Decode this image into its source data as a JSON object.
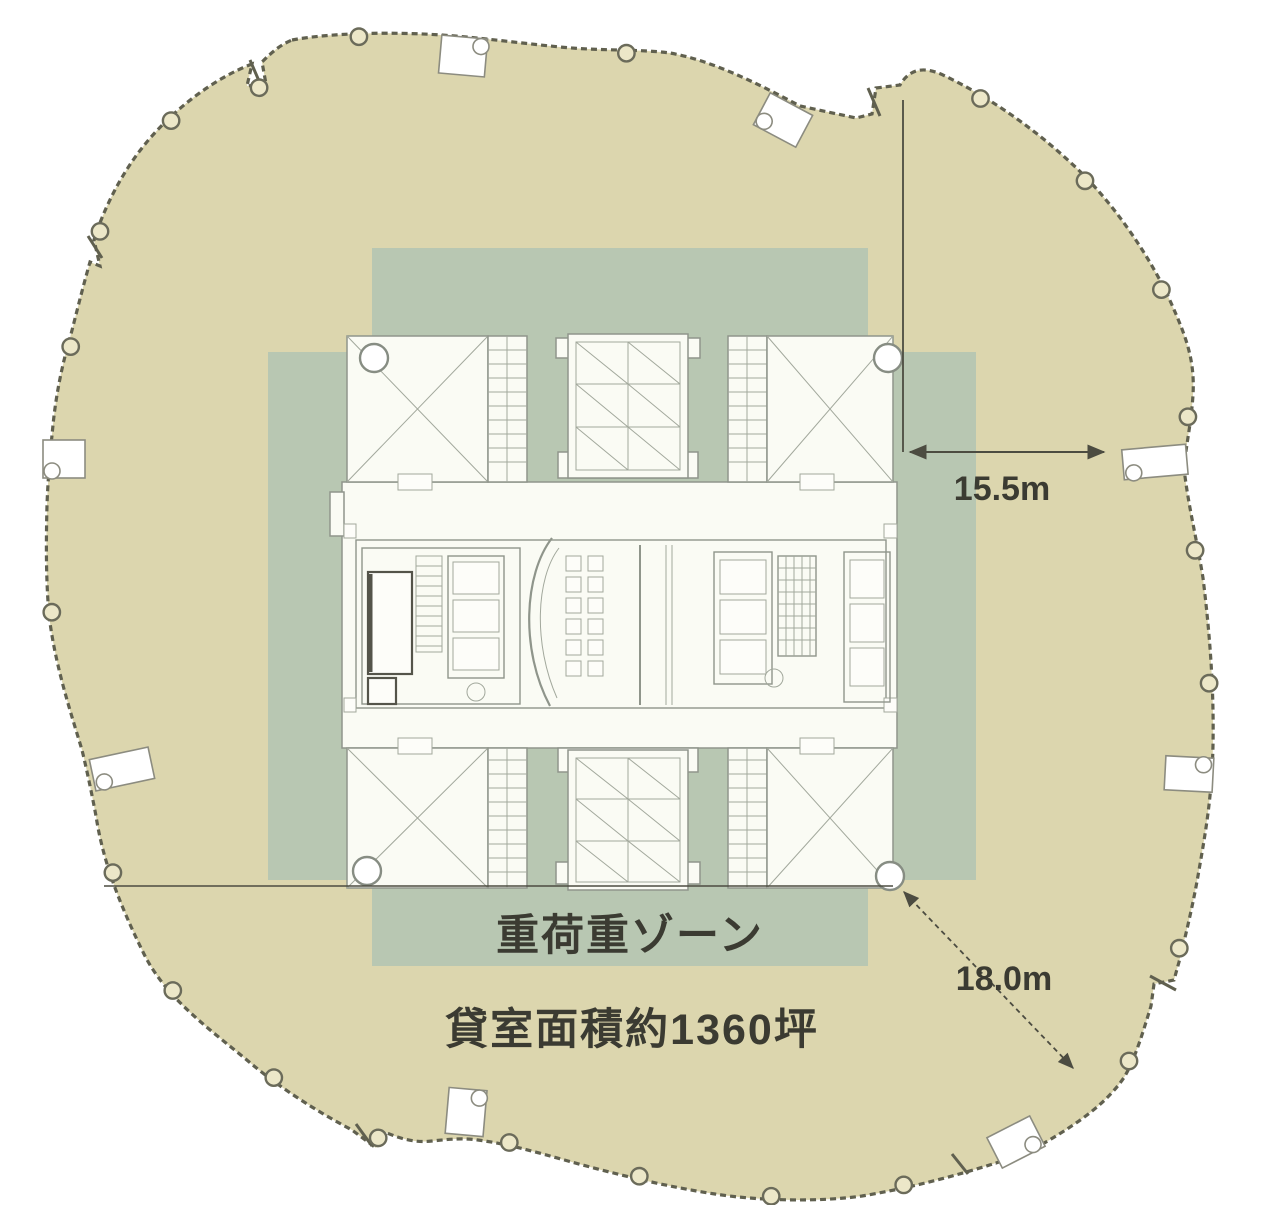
{
  "floor_plan": {
    "heavy_load_zone_label": "重荷重ゾーン",
    "rental_area_label": "貸室面積約1360坪",
    "dimension_core_to_edge": "15.5m",
    "dimension_corner_diagonal": "18.0m",
    "marker_count": 30,
    "colors": {
      "floor_fill": "#dcd6ae",
      "heavy_zone_fill": "#b8c7b2",
      "core_fill": "#fafbf4",
      "outline": "#60604f",
      "linework": "#8f958b",
      "dimension_line": "#4c4c41",
      "label_text": "#3b3b32",
      "background": "#ffffff"
    }
  }
}
